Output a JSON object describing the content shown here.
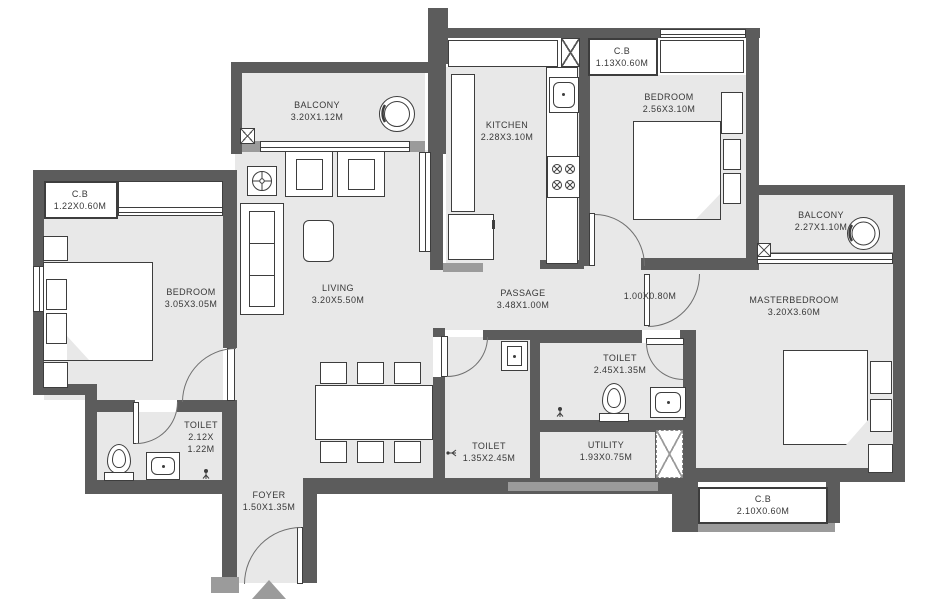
{
  "title": "2BHK apartment floor plan",
  "labels": {
    "balcony_top": {
      "line1": "BALCONY",
      "line2": "3.20X1.12M"
    },
    "kitchen": {
      "line1": "KITCHEN",
      "line2": "2.28X3.10M"
    },
    "cb_top": {
      "line1": "C.B",
      "line2": "1.13X0.60M"
    },
    "bedroom_top": {
      "line1": "BEDROOM",
      "line2": "2.56X3.10M"
    },
    "balcony_right": {
      "line1": "BALCONY",
      "line2": "2.27X1.10M"
    },
    "cb_left": {
      "line1": "C.B",
      "line2": "1.22X0.60M"
    },
    "bedroom_left": {
      "line1": "BEDROOM",
      "line2": "3.05X3.05M"
    },
    "living": {
      "line1": "LIVING",
      "line2": "3.20X5.50M"
    },
    "passage": {
      "line1": "PASSAGE",
      "line2": "3.48X1.00M"
    },
    "lobby": {
      "line1": "1.00X0.80M"
    },
    "masterbedroom": {
      "line1": "MASTERBEDROOM",
      "line2": "3.20X3.60M"
    },
    "toilet_master": {
      "line1": "TOILET",
      "line2": "2.45X1.35M"
    },
    "toilet_left": {
      "line1": "TOILET",
      "line2": "2.12X",
      "line3": "1.22M"
    },
    "toilet_bottom": {
      "line1": "TOILET",
      "line2": "1.35X2.45M"
    },
    "utility": {
      "line1": "UTILITY",
      "line2": "1.93X0.75M"
    },
    "foyer": {
      "line1": "FOYER",
      "line2": "1.50X1.35M"
    },
    "cb_bottom": {
      "line1": "C.B",
      "line2": "2.10X0.60M"
    }
  },
  "colors": {
    "wall": "#5c5c5c",
    "wall_light": "#9b9b9b",
    "floor": "#e8e8e8",
    "line": "#3d3d3d"
  },
  "icons": {
    "entrance_arrow": "triangle-up",
    "ceiling_fan": "circle-cross-in-box",
    "stove": "four-burners",
    "planter": "concentric-circles",
    "duct": "x-hatched-box",
    "shower": "spray-glyph"
  }
}
